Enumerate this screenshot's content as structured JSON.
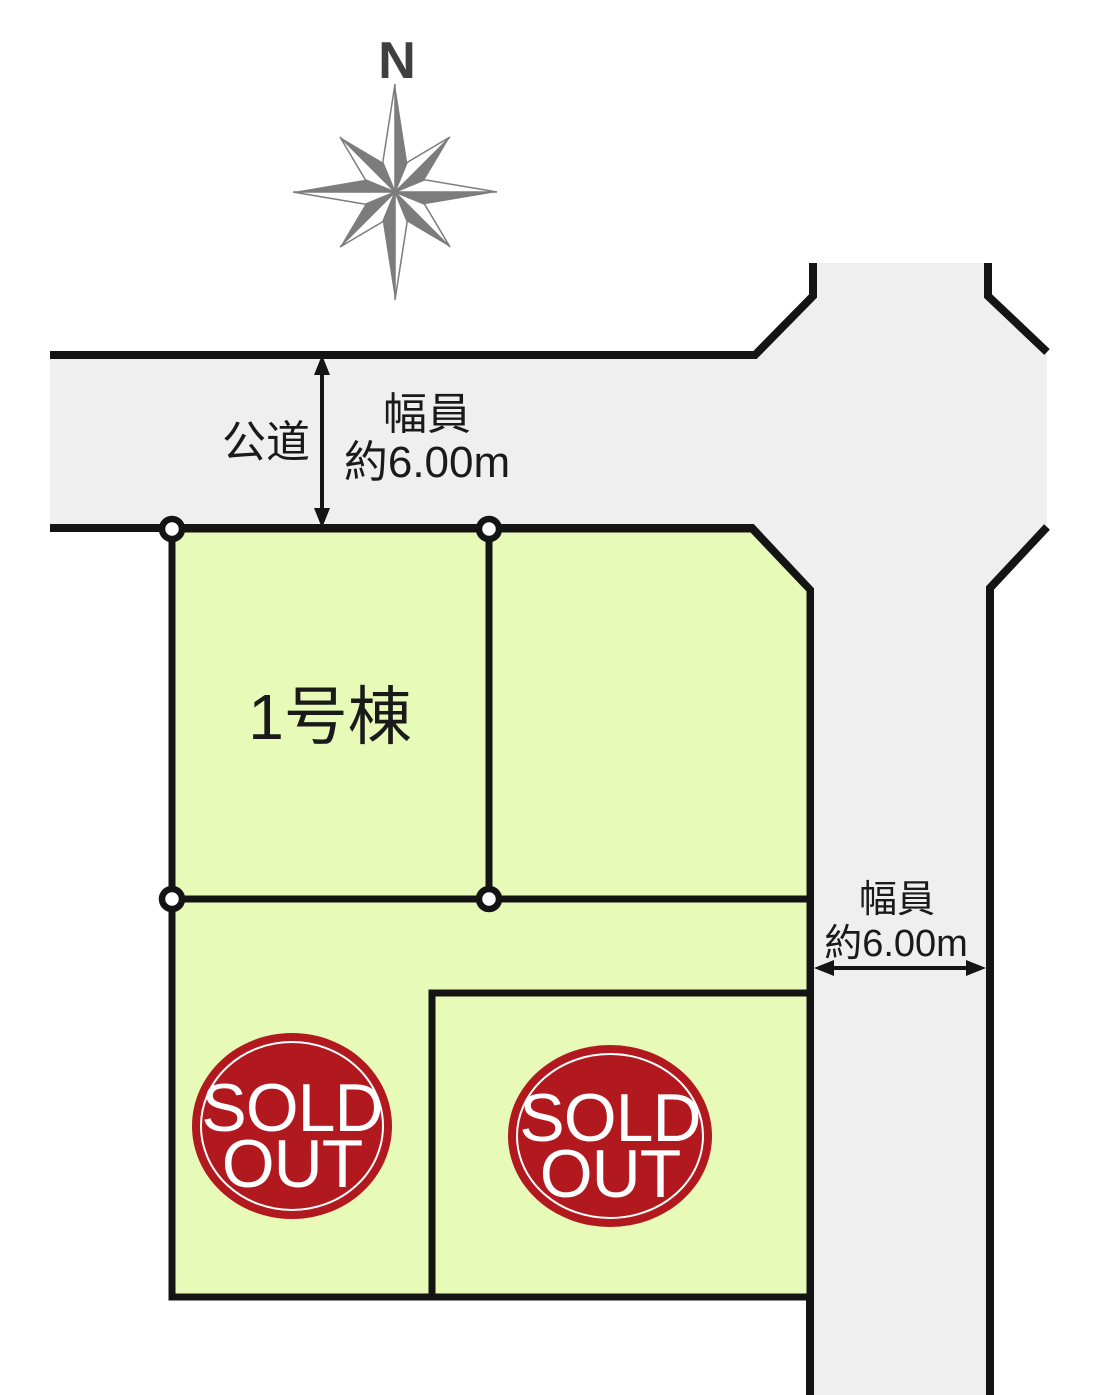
{
  "compass": {
    "north_label": "N"
  },
  "top_road": {
    "name": "公道",
    "width_caption": {
      "line1": "幅員",
      "line2": "約6.00m"
    }
  },
  "right_road": {
    "width_caption": {
      "line1": "幅員",
      "line2": "約6.00m"
    }
  },
  "lots": {
    "lot1_label": "1号棟"
  },
  "sold_badge": {
    "line1": "SOLD",
    "line2": "OUT"
  },
  "colors": {
    "road_fill": "#efefef",
    "lot_fill": "#e8fab8",
    "badge_fill": "#b2191f",
    "outline": "#141414",
    "compass_gray": "#7c7c7c"
  }
}
